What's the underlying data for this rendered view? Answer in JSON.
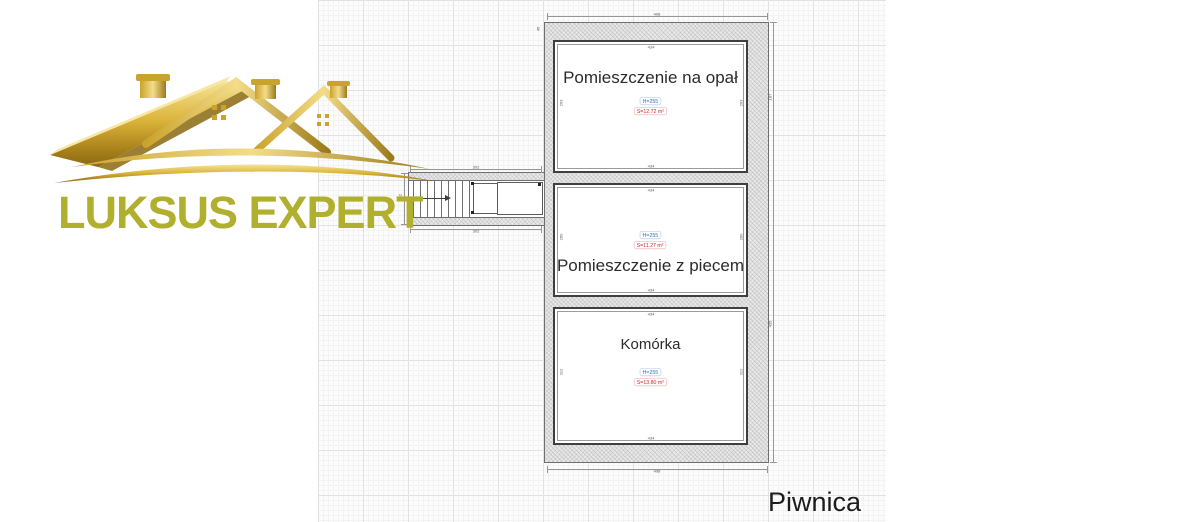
{
  "logo": {
    "text": "LUKSUS EXPERT",
    "icon": "golden-roofs-logo",
    "text_color": "#b1b02e",
    "gold_color": "#d4a72c"
  },
  "floor_plan": {
    "floor_label": "Piwnica",
    "rooms": [
      {
        "name": "Pomieszczenie na opał",
        "height": "H=255",
        "area": "S=12.72 m²",
        "width_dim": "434",
        "side_dim": "293"
      },
      {
        "name": "Pomieszczenie z piecem",
        "height": "H=255",
        "area": "S=11.27 m²",
        "width_dim": "434",
        "side_dim": "260"
      },
      {
        "name": "Komórka",
        "height": "H=255",
        "area": "S=13.80 m²",
        "width_dim": "434",
        "side_dim": "312"
      }
    ],
    "dimensions": {
      "outer_width_top": "498",
      "outer_width_bottom": "498",
      "corridor_width_top": "302",
      "corridor_width_bottom": "302",
      "corridor_height": "92",
      "outer_left_top": "45",
      "outer_right_upper": "167",
      "outer_right_lower": "435"
    },
    "colors": {
      "height_label": "#2e74b5",
      "area_label": "#c42b2b",
      "wall_fill": "#e9e9e9",
      "grid_major": "#e2e2e2",
      "grid_minor": "#f3f3f3"
    }
  }
}
